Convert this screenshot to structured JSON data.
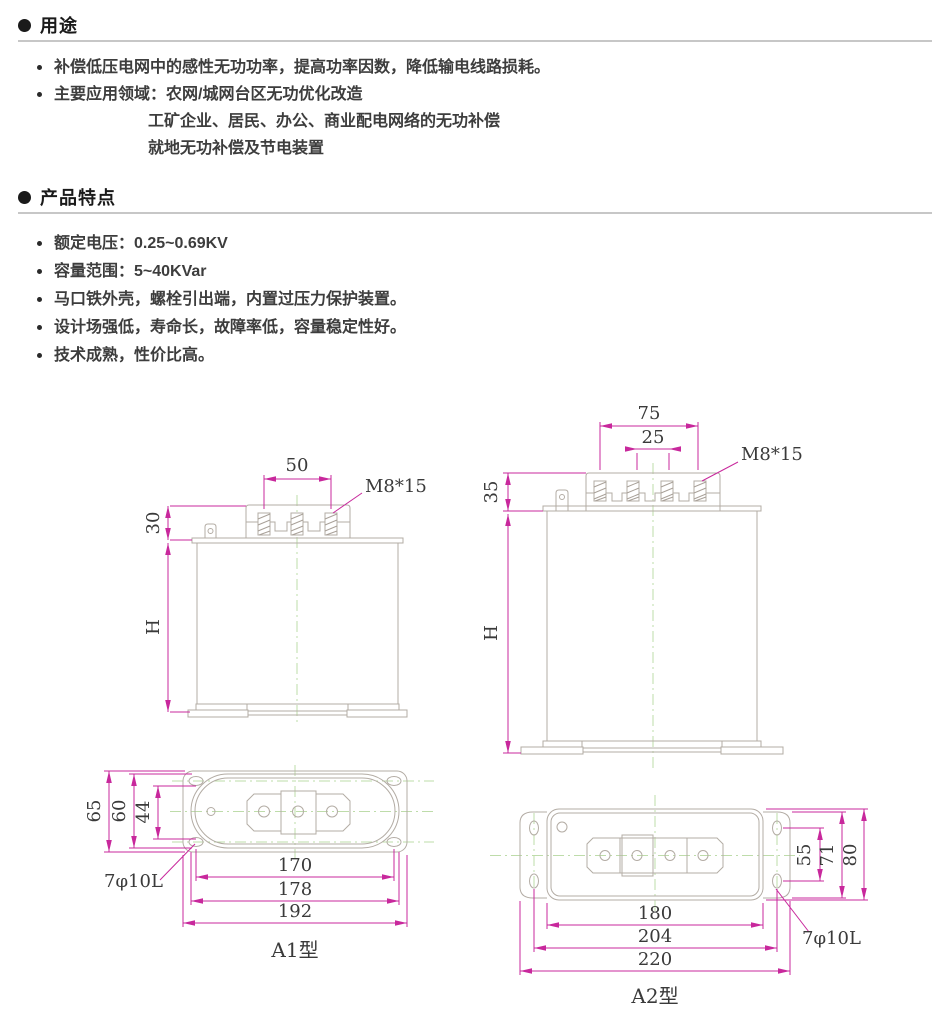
{
  "sections": {
    "usage": {
      "title": "用途",
      "items": [
        {
          "text": "补偿低压电网中的感性无功功率，提高功率因数，降低输电线路损耗。"
        },
        {
          "text": "主要应用领域：农网/城网台区无功优化改造"
        },
        {
          "text": "工矿企业、居民、办公、商业配电网络的无功补偿"
        },
        {
          "text": "就地无功补偿及节电装置"
        }
      ]
    },
    "features": {
      "title": "产品特点",
      "items": [
        {
          "text": "额定电压：0.25~0.69KV"
        },
        {
          "text": "容量范围：5~40KVar"
        },
        {
          "text": "马口铁外壳，螺栓引出端，内置过压力保护装置。"
        },
        {
          "text": "设计场强低，寿命长，故障率低，容量稳定性好。"
        },
        {
          "text": "技术成熟，性价比高。"
        }
      ]
    }
  },
  "drawings": {
    "a1": {
      "caption": "A1型",
      "side": {
        "terminal_pitch": "50",
        "thread_label": "M8*15",
        "cap_height": "30",
        "body_height": "H"
      },
      "bottom": {
        "plate_height": "65",
        "oval_height": "60",
        "hole_spacing_v": "44",
        "hole_spacing_h": "170",
        "oval_length": "178",
        "plate_length": "192",
        "hole_label": "7φ10L"
      }
    },
    "a2": {
      "caption": "A2型",
      "side": {
        "outer_pitch": "75",
        "inner_pitch": "25",
        "thread_label": "M8*15",
        "cap_height": "35",
        "body_height": "H"
      },
      "bottom": {
        "hole_spacing_v": "55",
        "bracket_height": "71",
        "body_height": "80",
        "body_length": "180",
        "hole_spacing_h": "204",
        "overall_length": "220",
        "hole_label": "7φ10L"
      }
    }
  },
  "colors": {
    "dimension": "#c8289c",
    "centerline": "#bedcaa",
    "outline": "#b3aca4",
    "text": "#3a3a3a"
  }
}
